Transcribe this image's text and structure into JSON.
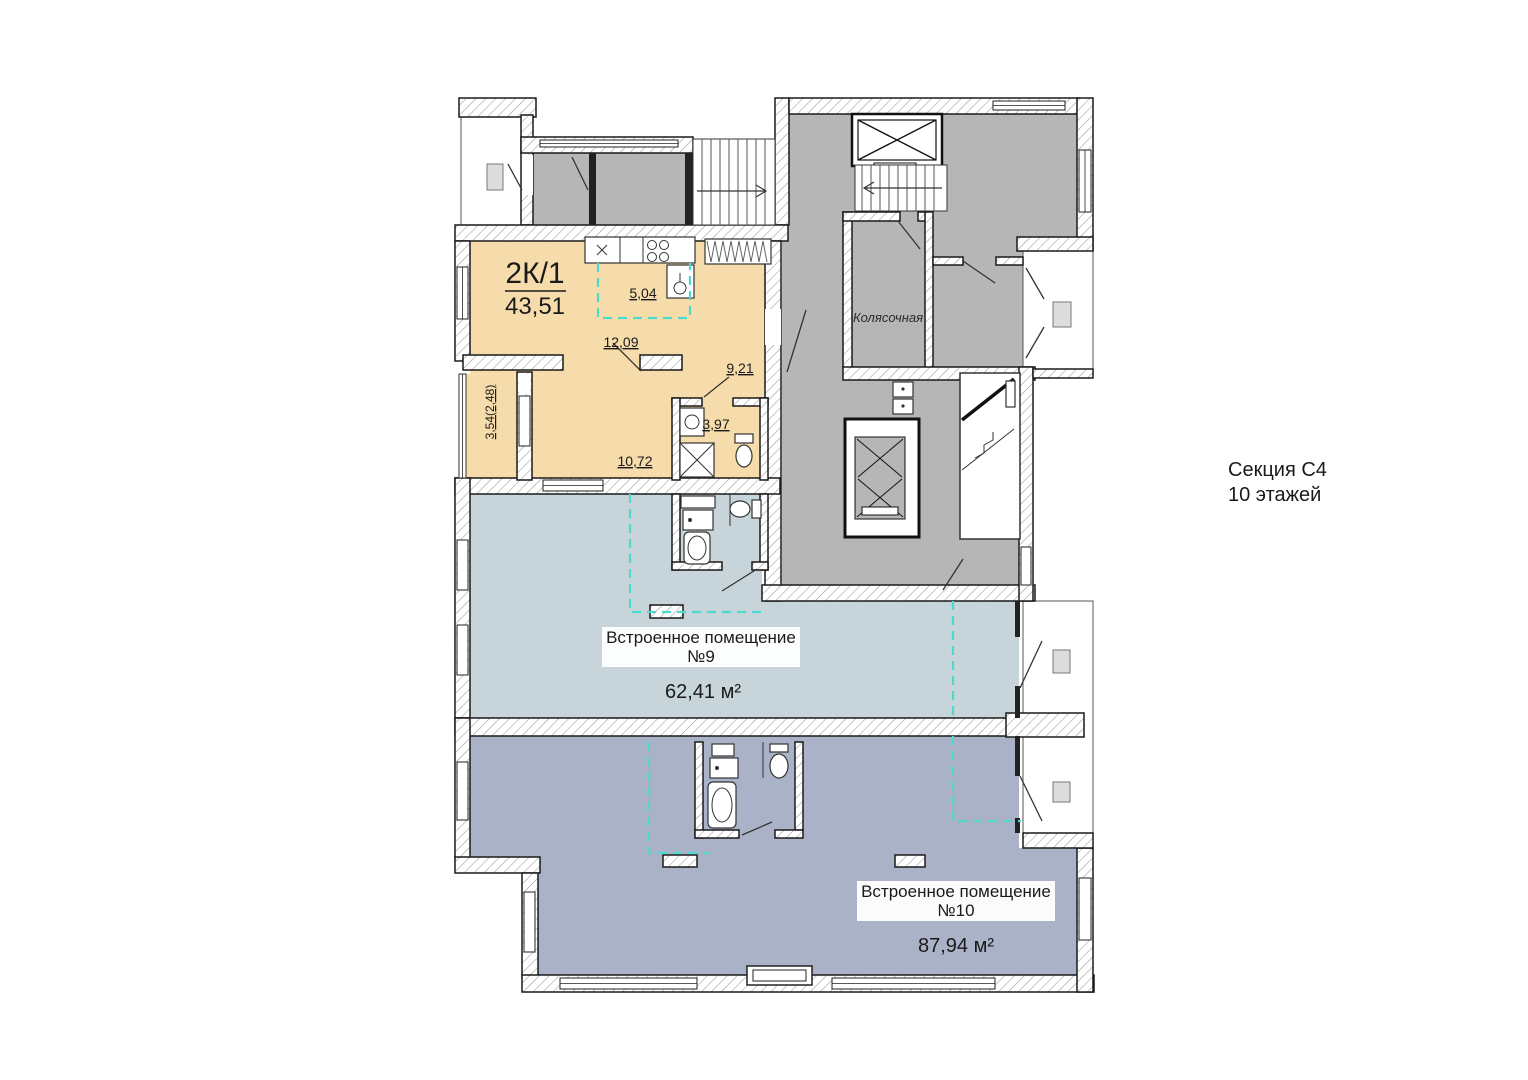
{
  "section_info": {
    "name": "Секция С4",
    "floors": "10 этажей"
  },
  "apartment": {
    "type": "2К/1",
    "total_area": "43,51",
    "areas": {
      "kitchen": "5,04",
      "living_room": "12,09",
      "hall": "9,21",
      "bathroom": "3,97",
      "bedroom": "10,72",
      "balcony": "3,54(2,48)"
    }
  },
  "common_areas": {
    "stroller_room": "Колясочная"
  },
  "premises": [
    {
      "title": "Встроенное помещение",
      "number": "№9",
      "area": "62,41 м²"
    },
    {
      "title": "Встроенное помещение",
      "number": "№10",
      "area": "87,94 м²"
    }
  ],
  "colors": {
    "apartment_fill": "#f7dcab",
    "common_fill": "#b6b6b6",
    "premises9_fill": "#c7d5db",
    "premises10_fill": "#a9b2c6",
    "planned_partition": "#4ed9cc",
    "wall": "#1a1a1a"
  }
}
